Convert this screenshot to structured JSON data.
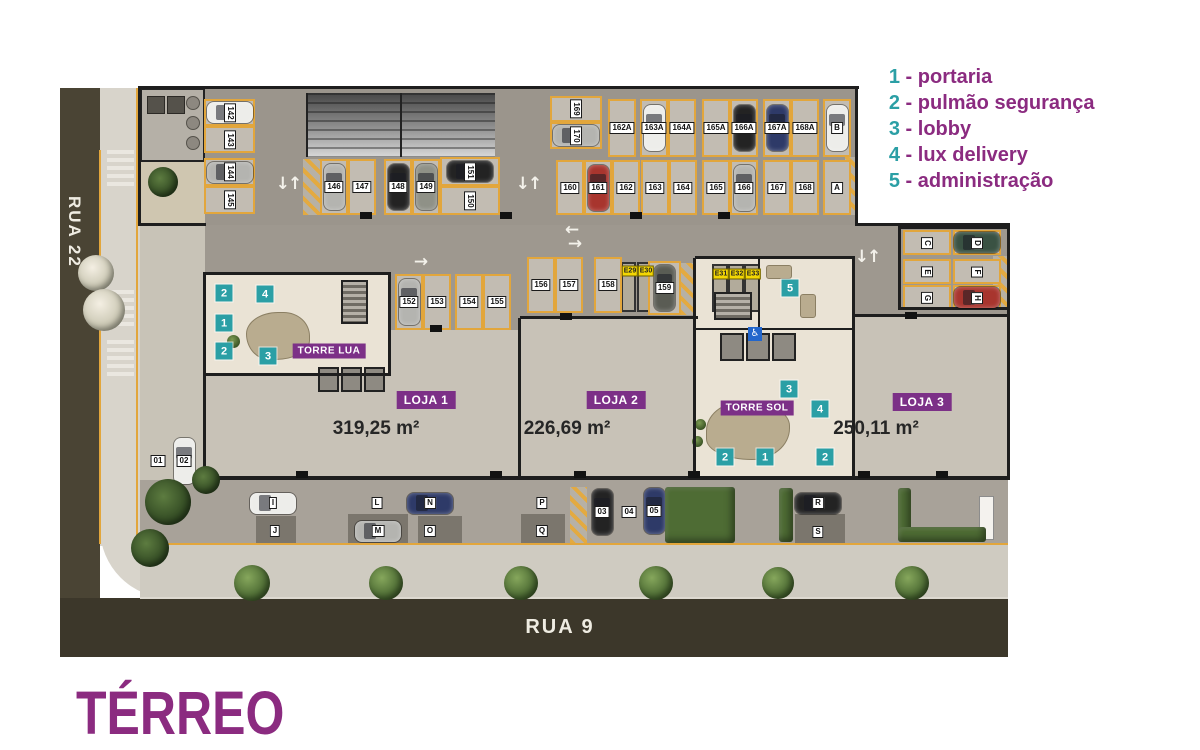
{
  "title": "TÉRREO",
  "streets": {
    "left": "RUA 22",
    "bottom": "RUA 9"
  },
  "legend": [
    {
      "num": "1",
      "label": "portaria"
    },
    {
      "num": "2",
      "label": "pulmão segurança"
    },
    {
      "num": "3",
      "label": "lobby"
    },
    {
      "num": "4",
      "label": "lux delivery"
    },
    {
      "num": "5",
      "label": "administração"
    }
  ],
  "towers": [
    {
      "name": "TORRE LUA",
      "x": 329,
      "y": 351
    },
    {
      "name": "TORRE SOL",
      "x": 757,
      "y": 408
    }
  ],
  "stores": [
    {
      "name": "LOJA 1",
      "area": "319,25 m²",
      "nx": 426,
      "ny": 400,
      "ax": 376,
      "ay": 429
    },
    {
      "name": "LOJA 2",
      "area": "226,69 m²",
      "nx": 616,
      "ny": 400,
      "ax": 567,
      "ay": 429
    },
    {
      "name": "LOJA 3",
      "area": "250,11 m²",
      "nx": 922,
      "ny": 402,
      "ax": 876,
      "ay": 429
    }
  ],
  "badges": [
    {
      "n": "2",
      "x": 224,
      "y": 293
    },
    {
      "n": "4",
      "x": 265,
      "y": 294
    },
    {
      "n": "1",
      "x": 224,
      "y": 323
    },
    {
      "n": "2",
      "x": 224,
      "y": 351
    },
    {
      "n": "3",
      "x": 268,
      "y": 356
    },
    {
      "n": "5",
      "x": 790,
      "y": 288
    },
    {
      "n": "3",
      "x": 789,
      "y": 389
    },
    {
      "n": "4",
      "x": 820,
      "y": 409
    },
    {
      "n": "2",
      "x": 725,
      "y": 457
    },
    {
      "n": "1",
      "x": 765,
      "y": 457
    },
    {
      "n": "2",
      "x": 825,
      "y": 457
    }
  ],
  "accessibility": {
    "x": 755,
    "y": 334,
    "glyph": "♿"
  },
  "e_spots": [
    {
      "id": "E29",
      "x": 630,
      "y": 271
    },
    {
      "id": "E30",
      "x": 646,
      "y": 271
    },
    {
      "id": "E31",
      "x": 721,
      "y": 274
    },
    {
      "id": "E32",
      "x": 737,
      "y": 274
    },
    {
      "id": "E33",
      "x": 753,
      "y": 274
    }
  ],
  "arrows": [
    {
      "t": "↓↑",
      "x": 288,
      "y": 184
    },
    {
      "t": "↓↑",
      "x": 528,
      "y": 184
    },
    {
      "t": "↓↑",
      "x": 867,
      "y": 257
    },
    {
      "t": "→",
      "x": 420,
      "y": 262
    },
    {
      "t": "←",
      "x": 571,
      "y": 230
    },
    {
      "t": "→",
      "x": 574,
      "y": 244
    }
  ],
  "parking": {
    "garage": [
      {
        "id": "142",
        "x": 204,
        "y": 99,
        "w": 51,
        "h": 27,
        "rot": 1,
        "car": "white",
        "dir": "h"
      },
      {
        "id": "143",
        "x": 204,
        "y": 126,
        "w": 51,
        "h": 27,
        "rot": 1
      },
      {
        "id": "144",
        "x": 204,
        "y": 158,
        "w": 51,
        "h": 28,
        "rot": 1,
        "car": "silver",
        "dir": "h"
      },
      {
        "id": "145",
        "x": 204,
        "y": 186,
        "w": 51,
        "h": 28,
        "rot": 1
      },
      {
        "id": "146",
        "x": 320,
        "y": 159,
        "w": 28,
        "h": 56,
        "car": "silver",
        "dir": "v"
      },
      {
        "id": "147",
        "x": 348,
        "y": 159,
        "w": 28,
        "h": 56
      },
      {
        "id": "148",
        "x": 384,
        "y": 159,
        "w": 28,
        "h": 56,
        "car": "black",
        "dir": "v"
      },
      {
        "id": "149",
        "x": 412,
        "y": 159,
        "w": 28,
        "h": 56,
        "car": "gray",
        "dir": "v"
      },
      {
        "id": "151",
        "x": 440,
        "y": 157,
        "w": 60,
        "h": 29,
        "rot": 1,
        "car": "black",
        "dir": "h"
      },
      {
        "id": "150",
        "x": 440,
        "y": 186,
        "w": 60,
        "h": 29,
        "rot": 1
      },
      {
        "id": "169",
        "x": 550,
        "y": 96,
        "w": 52,
        "h": 26,
        "rot": 1
      },
      {
        "id": "170",
        "x": 550,
        "y": 122,
        "w": 52,
        "h": 27,
        "rot": 1,
        "car": "silver",
        "dir": "h"
      },
      {
        "id": "162A",
        "x": 608,
        "y": 99,
        "w": 28,
        "h": 58
      },
      {
        "id": "163A",
        "x": 640,
        "y": 99,
        "w": 28,
        "h": 58,
        "car": "white",
        "dir": "v"
      },
      {
        "id": "164A",
        "x": 668,
        "y": 99,
        "w": 28,
        "h": 58
      },
      {
        "id": "165A",
        "x": 702,
        "y": 99,
        "w": 28,
        "h": 58
      },
      {
        "id": "166A",
        "x": 730,
        "y": 99,
        "w": 28,
        "h": 58,
        "car": "black",
        "dir": "v"
      },
      {
        "id": "167A",
        "x": 763,
        "y": 99,
        "w": 28,
        "h": 58,
        "car": "navy",
        "dir": "v"
      },
      {
        "id": "168A",
        "x": 791,
        "y": 99,
        "w": 28,
        "h": 58
      },
      {
        "id": "B",
        "x": 823,
        "y": 99,
        "w": 28,
        "h": 58,
        "car": "white",
        "dir": "v"
      },
      {
        "id": "160",
        "x": 556,
        "y": 160,
        "w": 28,
        "h": 55
      },
      {
        "id": "161",
        "x": 584,
        "y": 160,
        "w": 28,
        "h": 55,
        "car": "red",
        "dir": "v"
      },
      {
        "id": "162",
        "x": 612,
        "y": 160,
        "w": 28,
        "h": 55
      },
      {
        "id": "163",
        "x": 641,
        "y": 160,
        "w": 28,
        "h": 55
      },
      {
        "id": "164",
        "x": 669,
        "y": 160,
        "w": 28,
        "h": 55
      },
      {
        "id": "165",
        "x": 702,
        "y": 160,
        "w": 28,
        "h": 55
      },
      {
        "id": "166",
        "x": 730,
        "y": 160,
        "w": 28,
        "h": 55,
        "car": "silver",
        "dir": "v"
      },
      {
        "id": "167",
        "x": 763,
        "y": 160,
        "w": 28,
        "h": 55
      },
      {
        "id": "168",
        "x": 791,
        "y": 160,
        "w": 28,
        "h": 55
      },
      {
        "id": "A",
        "x": 823,
        "y": 160,
        "w": 28,
        "h": 55
      },
      {
        "id": "152",
        "x": 395,
        "y": 274,
        "w": 28,
        "h": 56,
        "car": "silver",
        "dir": "v"
      },
      {
        "id": "153",
        "x": 423,
        "y": 274,
        "w": 28,
        "h": 56
      },
      {
        "id": "154",
        "x": 455,
        "y": 274,
        "w": 28,
        "h": 56
      },
      {
        "id": "155",
        "x": 483,
        "y": 274,
        "w": 28,
        "h": 56
      },
      {
        "id": "156",
        "x": 527,
        "y": 257,
        "w": 28,
        "h": 56
      },
      {
        "id": "157",
        "x": 555,
        "y": 257,
        "w": 28,
        "h": 56
      },
      {
        "id": "158",
        "x": 594,
        "y": 257,
        "w": 28,
        "h": 56
      },
      {
        "id": "159",
        "x": 648,
        "y": 261,
        "w": 33,
        "h": 54,
        "car": "dark",
        "dir": "v"
      },
      {
        "id": "C",
        "x": 903,
        "y": 230,
        "w": 48,
        "h": 25,
        "rot": 1
      },
      {
        "id": "D",
        "x": 953,
        "y": 230,
        "w": 48,
        "h": 25,
        "rot": 1,
        "car": "green",
        "dir": "h"
      },
      {
        "id": "E",
        "x": 903,
        "y": 259,
        "w": 48,
        "h": 25,
        "rot": 1
      },
      {
        "id": "F",
        "x": 953,
        "y": 259,
        "w": 48,
        "h": 25,
        "rot": 1
      },
      {
        "id": "G",
        "x": 903,
        "y": 285,
        "w": 48,
        "h": 25,
        "rot": 1
      },
      {
        "id": "H",
        "x": 953,
        "y": 285,
        "w": 48,
        "h": 25,
        "rot": 1,
        "car": "red",
        "dir": "h"
      }
    ],
    "street": [
      {
        "id": "01",
        "x": 158,
        "y": 461
      },
      {
        "id": "02",
        "x": 184,
        "y": 461,
        "car": "white",
        "dir": "v"
      },
      {
        "id": "I",
        "x": 273,
        "y": 503,
        "car": "white",
        "dir": "h"
      },
      {
        "id": "J",
        "x": 275,
        "y": 531
      },
      {
        "id": "L",
        "x": 377,
        "y": 503
      },
      {
        "id": "M",
        "x": 378,
        "y": 531,
        "car": "silver",
        "dir": "h"
      },
      {
        "id": "N",
        "x": 430,
        "y": 503,
        "car": "navy",
        "dir": "h"
      },
      {
        "id": "O",
        "x": 430,
        "y": 531
      },
      {
        "id": "P",
        "x": 542,
        "y": 503
      },
      {
        "id": "Q",
        "x": 542,
        "y": 531
      },
      {
        "id": "03",
        "x": 602,
        "y": 512,
        "car": "black",
        "dir": "v"
      },
      {
        "id": "04",
        "x": 629,
        "y": 512
      },
      {
        "id": "05",
        "x": 654,
        "y": 511,
        "car": "navy",
        "dir": "v"
      },
      {
        "id": "R",
        "x": 818,
        "y": 503,
        "car": "black",
        "dir": "h"
      },
      {
        "id": "S",
        "x": 818,
        "y": 532
      }
    ]
  },
  "colors": {
    "purple": "#8B2B80",
    "tagPurple": "#7C3087",
    "teal": "#2B9FA5",
    "yellow": "#E2A63C",
    "roadLeft": "#4A4434",
    "roadBottom": "#3C372A",
    "garage": "#9B958C",
    "store": "#C8C2B7",
    "lobby": "#EAE3D5",
    "spot": "#C2BCB2",
    "wall": "#1E1E1E",
    "areaText": "#262626"
  }
}
